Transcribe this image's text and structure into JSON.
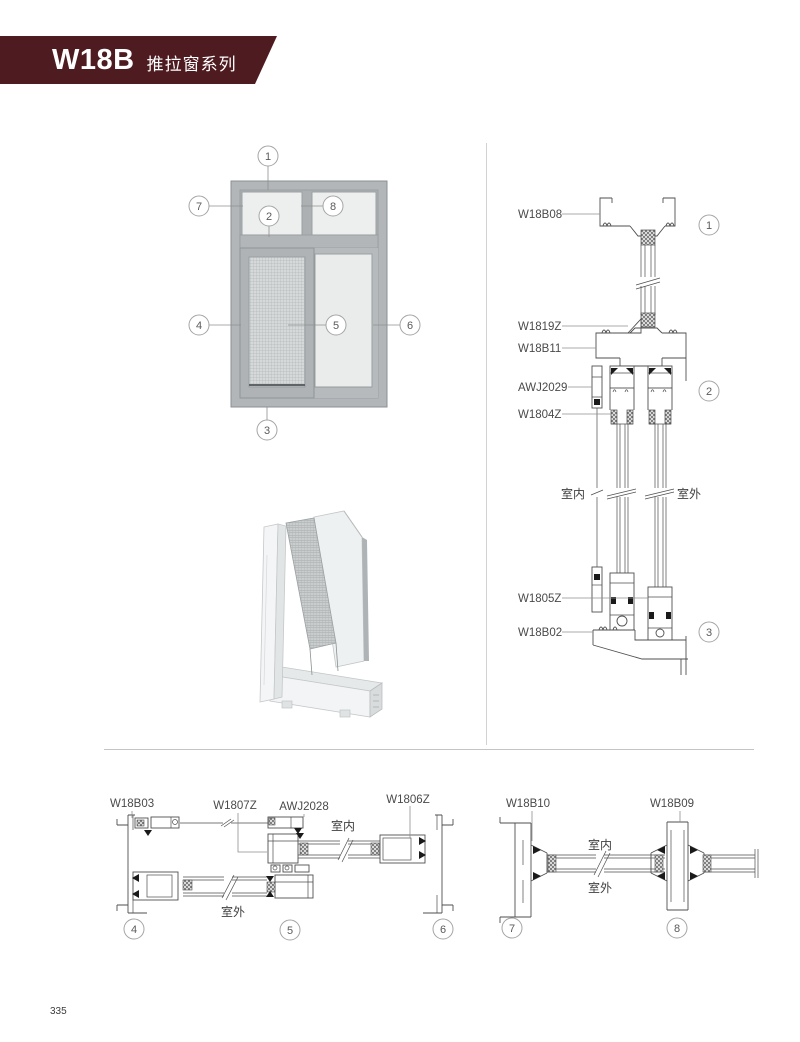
{
  "page": {
    "page_number": "335"
  },
  "banner": {
    "code": "W18B",
    "series": "推拉窗系列",
    "color": "#4e1b20"
  },
  "elevation": {
    "callouts": {
      "c1": "1",
      "c2": "2",
      "c3": "3",
      "c4": "4",
      "c5": "5",
      "c6": "6",
      "c7": "7",
      "c8": "8"
    }
  },
  "vertical_section": {
    "labels": {
      "top_frame": "W18B08",
      "glass_wedge": "W1819Z",
      "transom": "W18B11",
      "screen": "AWJ2029",
      "sash_glazing": "W1804Z",
      "sash_bottom": "W1805Z",
      "bottom_frame": "W18B02"
    },
    "indoor": "室内",
    "outdoor": "室外",
    "callouts": {
      "c1": "1",
      "c2": "2",
      "c3": "3"
    }
  },
  "bottom_left_section": {
    "labels": {
      "left_jamb": "W18B03",
      "interlock": "W1807Z",
      "screen": "AWJ2028",
      "sash_stile": "W1806Z"
    },
    "indoor": "室内",
    "outdoor": "室外",
    "callouts": {
      "c4": "4",
      "c5": "5",
      "c6": "6"
    }
  },
  "bottom_right_section": {
    "labels": {
      "jamb": "W18B10",
      "mullion": "W18B09"
    },
    "indoor": "室内",
    "outdoor": "室外",
    "callouts": {
      "c7": "7",
      "c8": "8"
    }
  }
}
